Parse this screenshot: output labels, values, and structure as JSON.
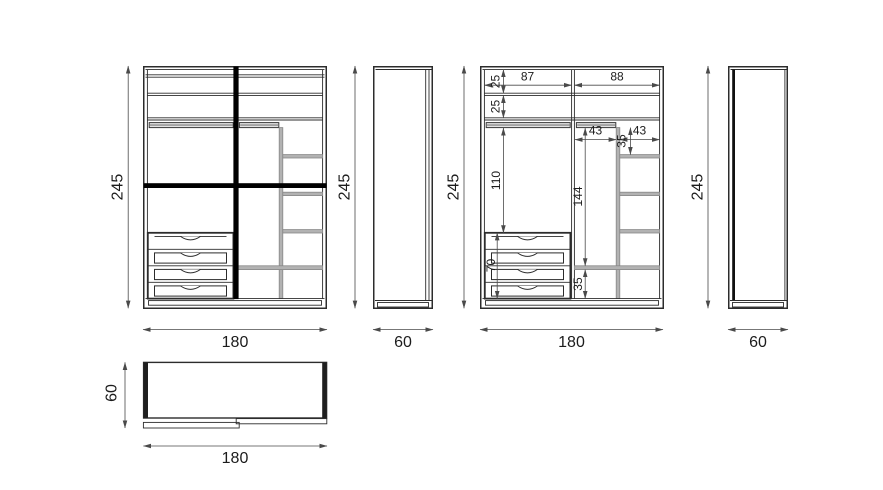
{
  "drawing": {
    "front_view": {
      "height": "245",
      "width": "180"
    },
    "side_view_left": {
      "height": "245",
      "width": "60"
    },
    "front_view_dimensioned": {
      "height": "245",
      "width": "180",
      "internal": {
        "top_compartment_height": "25",
        "second_compartment_height": "25",
        "left_section_width": "87",
        "right_section_width": "88",
        "sub_left_width": "43",
        "sub_right_width": "43",
        "top_right_shelf_gap": "35",
        "hanging_space_height": "110",
        "right_hanging_height": "144",
        "drawer_unit_height": "70",
        "bottom_compartment_height": "35"
      }
    },
    "side_view_right": {
      "height": "245",
      "width": "60"
    },
    "top_view": {
      "width": "180",
      "depth": "60"
    }
  }
}
